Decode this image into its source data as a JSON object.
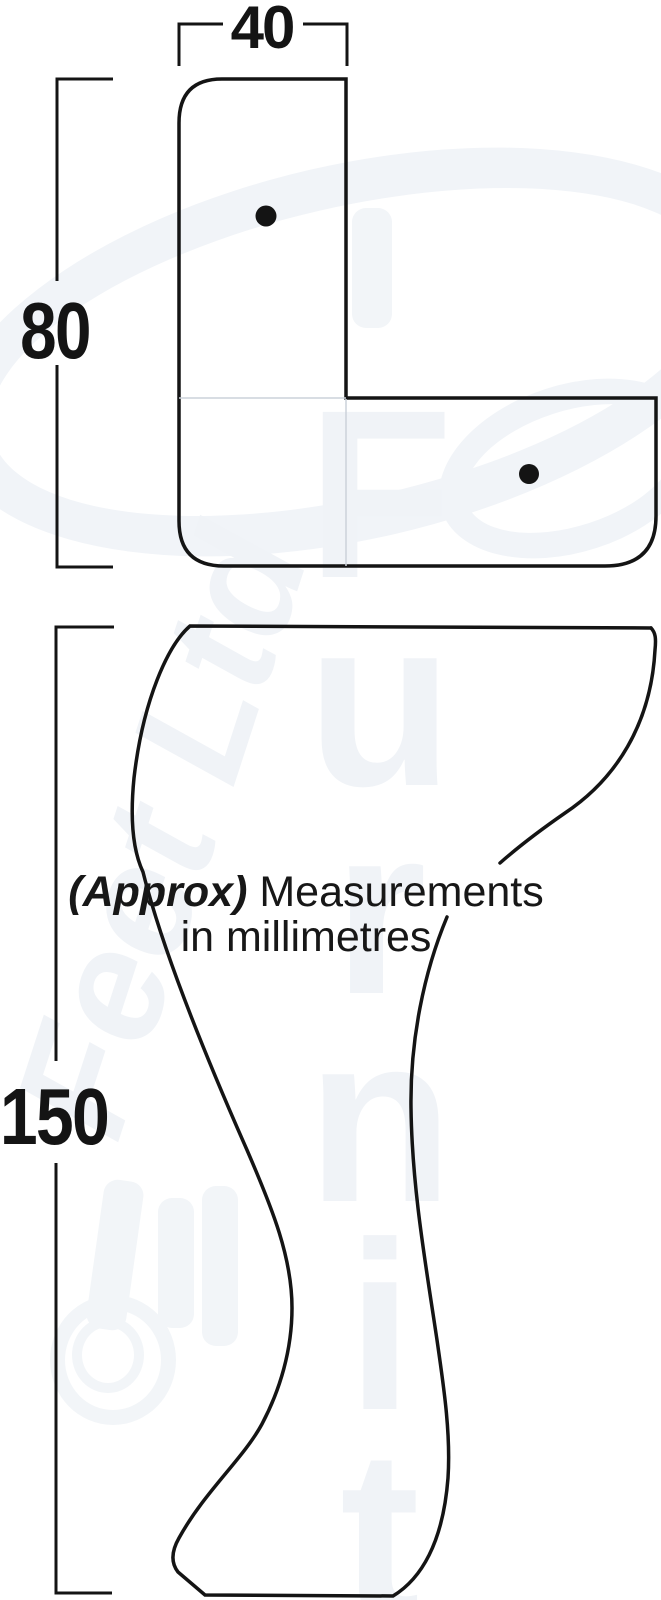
{
  "diagram": {
    "top_view": {
      "width_label": "40",
      "height_label": "80",
      "screw_holes": 2
    },
    "side_view": {
      "height_label": "150"
    },
    "note": {
      "emphasis": "(Approx)",
      "line1_rest": "Measurements",
      "line2": "in millimetres"
    },
    "watermark": {
      "word1": "Furniture",
      "word2": "Feet Ltd"
    },
    "colors": {
      "line": "#141414",
      "faint_joint_line": "#ccd2da",
      "watermark": "#f0f3f7",
      "background": "#ffffff"
    }
  }
}
